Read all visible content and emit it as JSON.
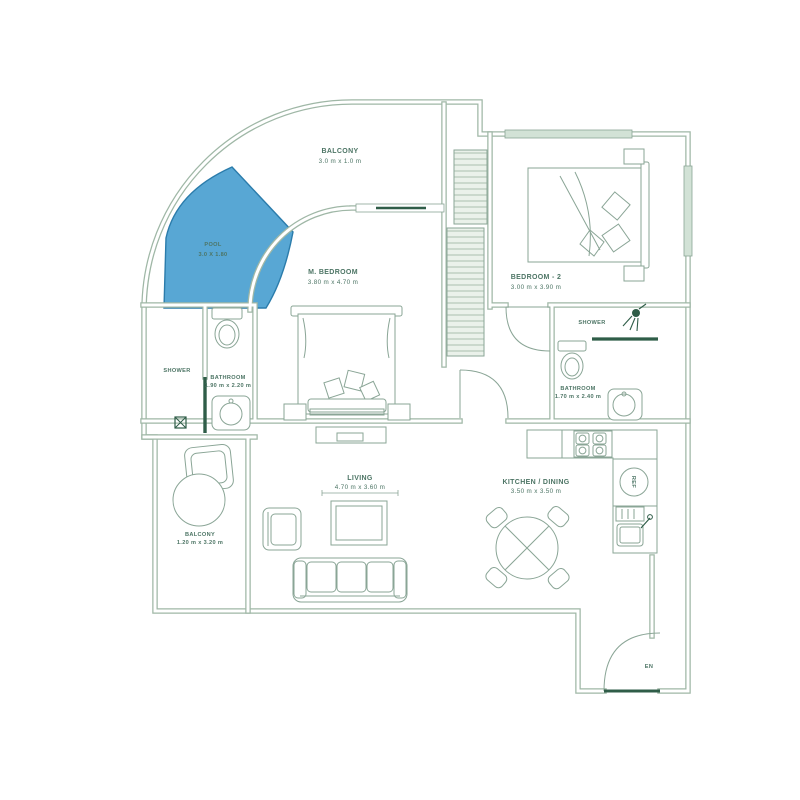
{
  "floor_plan": {
    "labels": {
      "balcony_top_name": "BALCONY",
      "balcony_top_dims": "3.0 m x 1.0 m",
      "pool_name": "POOL",
      "pool_dims": "3.0 X 1.80",
      "master_bedroom_name": "M. BEDROOM",
      "master_bedroom_dims": "3.80 m x 4.70 m",
      "bedroom2_name": "BEDROOM - 2",
      "bedroom2_dims": "3.00 m x 3.90 m",
      "shower_right_name": "SHOWER",
      "bathroom_right_name": "BATHROOM",
      "bathroom_right_dims": "1.70 m x 2.40 m",
      "shower_left_name": "SHOWER",
      "bathroom_left_name": "BATHROOM",
      "bathroom_left_dims": "1.90 m x 2.20 m",
      "living_name": "LIVING",
      "living_dims": "4.70 m x 3.60 m",
      "kitchen_name": "KITCHEN / DINING",
      "kitchen_dims": "3.50 m x 3.50 m",
      "balcony_left_name": "BALCONY",
      "balcony_left_dims": "1.20 m x 3.20 m",
      "entry_label": "EN",
      "fridge_label": "REF"
    },
    "colors": {
      "wall": "#9fb7a6",
      "text": "#4d7565",
      "pool_fill": "#58a7d4",
      "pool_edge": "#2b7cab",
      "accent_dark": "#2f5d48",
      "window_fill": "#d2e2d6",
      "hatch_line": "#a9c0ae"
    }
  }
}
